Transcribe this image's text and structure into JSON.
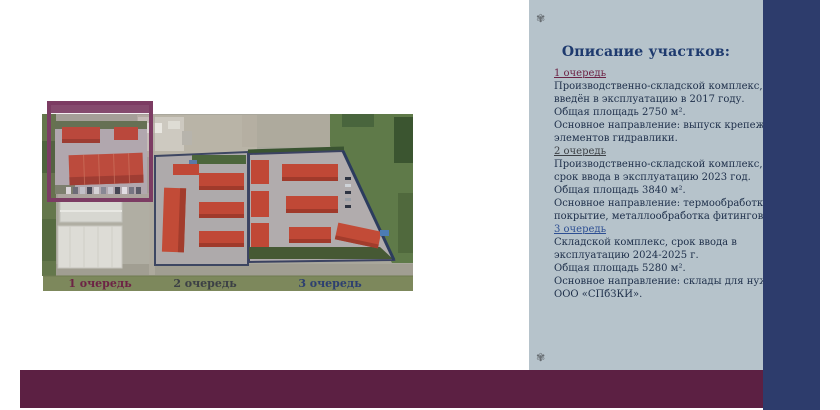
{
  "panel": {
    "ornament": "✾",
    "title": "Описание участков:",
    "sections": [
      {
        "heading": "1 очередь",
        "body": "Производственно-складской комплекс,\nвведён в эксплуатацию в 2017 году.\nОбщая площадь 2750 м².\nОсновное направление: выпуск крепежа и\nэлементов гидравлики."
      },
      {
        "heading": "2 очередь",
        "body": "Производственно-складской комплекс,\nсрок ввода в эксплуатацию 2023 год.\nОбщая площадь 3840 м².\nОсновное направление: термообработка,\nпокрытие, металлообработка фитингов."
      },
      {
        "heading": "3 очередь",
        "body": "Складской комплекс, срок ввода в\nэксплуатацию 2024-2025 г.\nОбщая площадь 5280 м².\nОсновное направление: склады для нужд\nООО «СПбЗКИ»."
      }
    ]
  },
  "map": {
    "labels": [
      "1 очередь",
      "2 очередь",
      "3 очередь"
    ]
  },
  "colors": {
    "panel_bg": "#b6c3cb",
    "accent_bar_blue": "#2d3c6c",
    "bottom_bar_maroon": "#5c2043",
    "title_text": "#1e3a6e",
    "body_text": "#1e2f4a",
    "heading_1": "#6d2345",
    "heading_2": "#3c4045",
    "heading_3": "#2d4f93",
    "label_strip_olive": "#7d885c",
    "label_1": "#6d2345",
    "label_2": "#3c4045",
    "label_3": "#2d3f70",
    "roof_red": "#c04836",
    "frame_purple": "#7c3c63"
  }
}
